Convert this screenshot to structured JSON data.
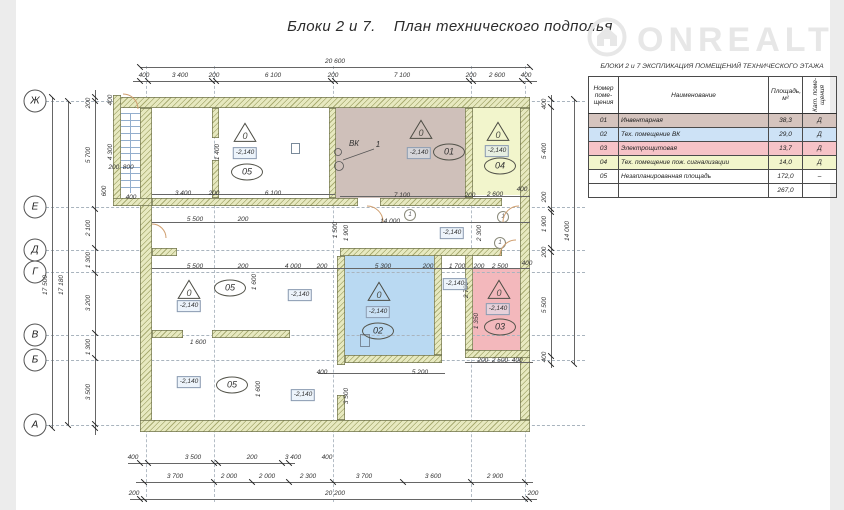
{
  "title": "Блоки 2 и 7.    План технического подполья",
  "watermark": {
    "text": "ONREALT",
    "icon": "house-in-circle-icon",
    "color": "#e7e7e7"
  },
  "legend_table": {
    "title": "БЛОКИ  2 и 7   ЭКСПЛИКАЦИЯ ПОМЕЩЕНИЙ ТЕХНИЧЕСКОГО ЭТАЖА",
    "columns": [
      "Номер\nпоме-\nщения",
      "Наименование",
      "Площадь,\nм²",
      "Кат. поме-\nщения"
    ],
    "rows": [
      {
        "num": "01",
        "name": "Инвентарная",
        "area": "38,3",
        "cat": "Д",
        "fill": "#d5c4be"
      },
      {
        "num": "02",
        "name": "Тех. помещение ВК",
        "area": "29,0",
        "cat": "Д",
        "fill": "#cde2f6"
      },
      {
        "num": "03",
        "name": "Электрощитовая",
        "area": "13,7",
        "cat": "Д",
        "fill": "#f6c3c7"
      },
      {
        "num": "04",
        "name": "Тех. помещение пож. сигнализации",
        "area": "14,0",
        "cat": "Д",
        "fill": "#f2f5cb"
      },
      {
        "num": "05",
        "name": "Незапланированная площадь",
        "area": "172,0",
        "cat": "–",
        "fill": "#ffffff"
      }
    ],
    "total_area": "267,0"
  },
  "plan": {
    "level_mark": "-2,140",
    "category_glyph": "0",
    "row_axes": [
      [
        "Ж",
        101
      ],
      [
        "Е",
        207
      ],
      [
        "Д",
        250
      ],
      [
        "Г",
        272
      ],
      [
        "В",
        335
      ],
      [
        "Б",
        360
      ],
      [
        "А",
        425
      ]
    ],
    "room_fills": [
      {
        "id": "01",
        "x": 335,
        "y": 108,
        "w": 130,
        "h": 90,
        "fill": "#cfc0ba"
      },
      {
        "id": "02",
        "x": 345,
        "y": 256,
        "w": 89,
        "h": 99,
        "fill": "#b9d9f2"
      },
      {
        "id": "03",
        "x": 473,
        "y": 268,
        "w": 47,
        "h": 82,
        "fill": "#f3b8bc"
      },
      {
        "id": "04",
        "x": 473,
        "y": 108,
        "w": 47,
        "h": 87,
        "fill": "#f2f5cc"
      }
    ],
    "room_tags": [
      {
        "label": "01",
        "x": 449,
        "y": 152
      },
      {
        "label": "02",
        "x": 378,
        "y": 331
      },
      {
        "label": "03",
        "x": 500,
        "y": 327
      },
      {
        "label": "04",
        "x": 500,
        "y": 166
      },
      {
        "label": "05",
        "x": 247,
        "y": 172
      },
      {
        "label": "05",
        "x": 230,
        "y": 288
      },
      {
        "label": "05",
        "x": 232,
        "y": 385
      }
    ],
    "triangles": [
      [
        421,
        131
      ],
      [
        379,
        293
      ],
      [
        499,
        291
      ],
      [
        498,
        133
      ],
      [
        245,
        134
      ],
      [
        189,
        291
      ]
    ],
    "level_positions": [
      [
        419,
        153
      ],
      [
        378,
        312
      ],
      [
        498,
        309
      ],
      [
        497,
        151
      ],
      [
        245,
        153
      ],
      [
        189,
        306
      ],
      [
        189,
        382
      ],
      [
        452,
        233
      ],
      [
        455,
        284
      ],
      [
        300,
        295
      ],
      [
        303,
        395
      ]
    ],
    "door_tags": [
      {
        "label": "1",
        "x": 410,
        "y": 215
      },
      {
        "label": "1",
        "x": 503,
        "y": 217
      },
      {
        "label": "1",
        "x": 500,
        "y": 243
      }
    ],
    "dim_labels": [
      [
        "20 600",
        335,
        62
      ],
      [
        "400",
        144,
        76
      ],
      [
        "3 400",
        180,
        76
      ],
      [
        "200",
        214,
        76
      ],
      [
        "6 100",
        273,
        76
      ],
      [
        "200",
        333,
        76
      ],
      [
        "7 100",
        402,
        76
      ],
      [
        "200",
        471,
        76
      ],
      [
        "2 600",
        497,
        76
      ],
      [
        "400",
        526,
        76
      ],
      [
        "400",
        133,
        458
      ],
      [
        "3 500",
        193,
        458
      ],
      [
        "200",
        252,
        458
      ],
      [
        "3 400",
        293,
        458
      ],
      [
        "400",
        327,
        458
      ],
      [
        "3 700",
        175,
        477
      ],
      [
        "2 000",
        229,
        477
      ],
      [
        "2 000",
        267,
        477
      ],
      [
        "2 300",
        308,
        477
      ],
      [
        "3 700",
        364,
        477
      ],
      [
        "3 600",
        433,
        477
      ],
      [
        "2 900",
        495,
        477
      ],
      [
        "200",
        134,
        494
      ],
      [
        "20 200",
        335,
        494
      ],
      [
        "200",
        533,
        494
      ],
      [
        "17 500",
        46,
        285,
        1
      ],
      [
        "17 180",
        62,
        285,
        1
      ],
      [
        "200",
        89,
        103,
        1
      ],
      [
        "5 700",
        89,
        155,
        1
      ],
      [
        "2 100",
        89,
        228,
        1
      ],
      [
        "1 300",
        89,
        260,
        1
      ],
      [
        "3 200",
        89,
        303,
        1
      ],
      [
        "1 300",
        89,
        347,
        1
      ],
      [
        "3 500",
        89,
        392,
        1
      ],
      [
        "400",
        111,
        100,
        1
      ],
      [
        "4 300",
        111,
        152,
        1
      ],
      [
        "600",
        105,
        191,
        1
      ],
      [
        "200  800",
        121,
        168
      ],
      [
        "400",
        131,
        198
      ],
      [
        "400",
        545,
        104,
        1
      ],
      [
        "5 400",
        545,
        151,
        1
      ],
      [
        "200",
        545,
        197,
        1
      ],
      [
        "1 900",
        545,
        224,
        1
      ],
      [
        "200",
        545,
        252,
        1
      ],
      [
        "5 500",
        545,
        305,
        1
      ],
      [
        "400",
        545,
        357,
        1
      ],
      [
        "14 000",
        568,
        231,
        1
      ],
      [
        "7 100",
        402,
        196
      ],
      [
        "200",
        470,
        196
      ],
      [
        "2 600",
        495,
        195
      ],
      [
        "400",
        522,
        190
      ],
      [
        "3 400",
        183,
        194
      ],
      [
        "200",
        214,
        194
      ],
      [
        "6 100",
        273,
        194
      ],
      [
        "5 500",
        195,
        220
      ],
      [
        "200",
        243,
        220
      ],
      [
        "14 000",
        390,
        222
      ],
      [
        "5 500",
        195,
        267
      ],
      [
        "200",
        243,
        267
      ],
      [
        "4 000",
        293,
        267
      ],
      [
        "200",
        322,
        267
      ],
      [
        "5 300",
        383,
        267
      ],
      [
        "200",
        428,
        267
      ],
      [
        "1 700",
        457,
        267
      ],
      [
        "200",
        479,
        267
      ],
      [
        "2 500",
        500,
        267
      ],
      [
        "400",
        527,
        264
      ],
      [
        "1 500",
        336,
        230,
        1
      ],
      [
        "1 900",
        347,
        233,
        1
      ],
      [
        "2 300",
        480,
        233,
        1
      ],
      [
        "1 400",
        218,
        152,
        1
      ],
      [
        "1 600",
        198,
        343
      ],
      [
        "1 600",
        255,
        282,
        1
      ],
      [
        "1 600",
        259,
        389,
        1
      ],
      [
        "2 700",
        467,
        290,
        1
      ],
      [
        "1 350",
        477,
        321,
        1
      ],
      [
        "200  2 500  400",
        500,
        361
      ],
      [
        "400",
        322,
        373
      ],
      [
        "5 200",
        420,
        373
      ],
      [
        "3 500",
        347,
        396,
        1
      ],
      [
        "ВК",
        354,
        144,
        0,
        8
      ],
      [
        "1",
        378,
        145,
        0,
        8
      ]
    ]
  },
  "palette": {
    "wall_fill": "#e7e9c0",
    "wall_hatch": "#a9ac72",
    "wall_edge": "#71744e",
    "dim_line": "#666666",
    "axis_line": "#a9b4be",
    "door_arc": "#cf9e6e",
    "stair": "#93aecd"
  }
}
